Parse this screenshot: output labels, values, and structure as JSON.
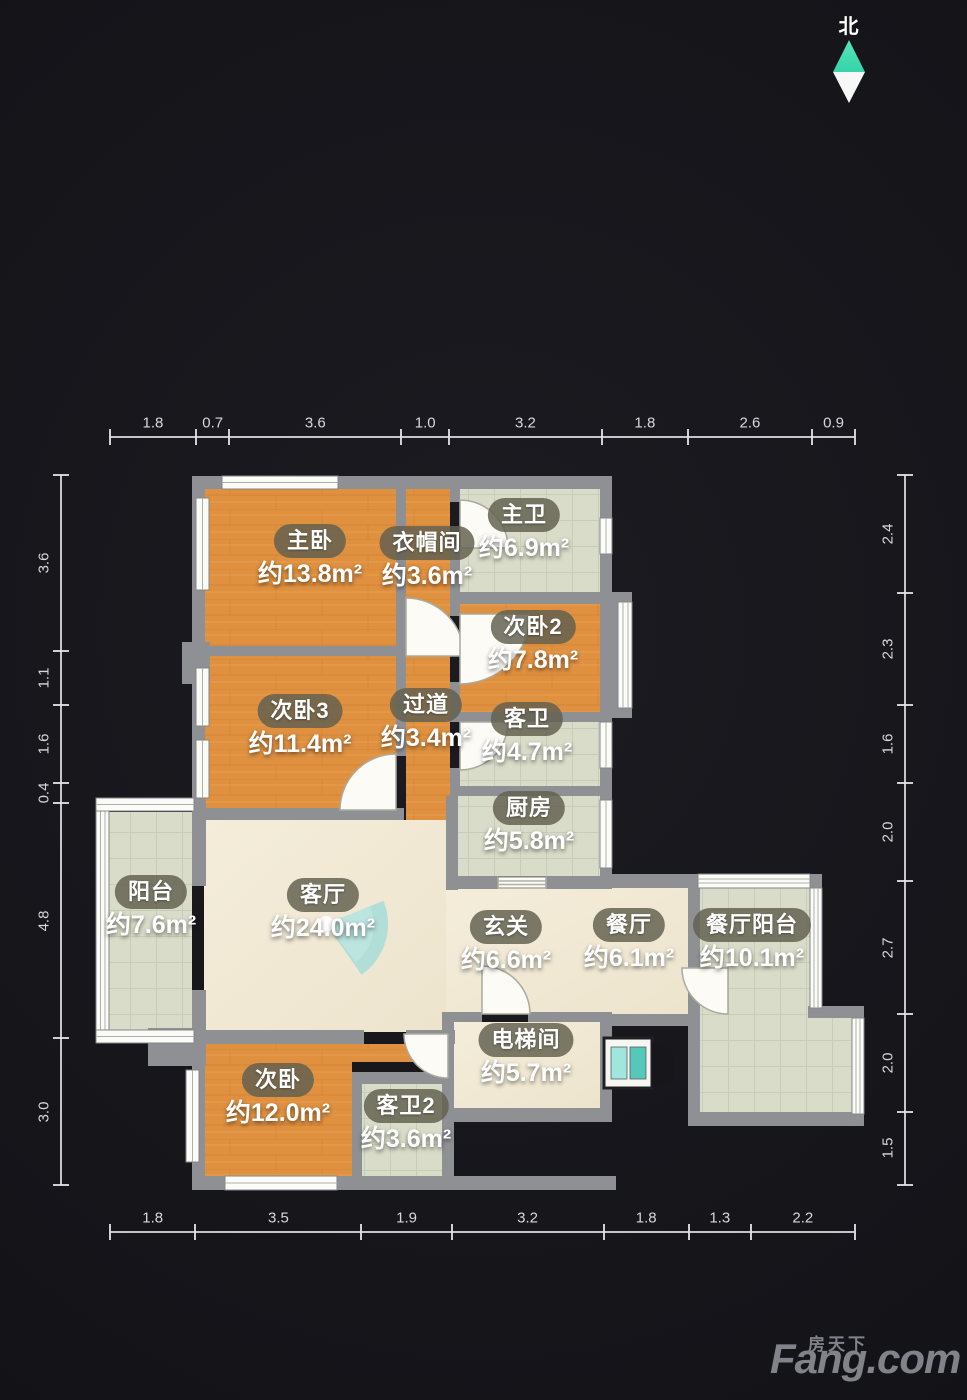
{
  "north": {
    "label": "北"
  },
  "watermark": {
    "site_cn": "房天下",
    "site_en": "Fang.com"
  },
  "dims": {
    "top": [
      "1.8",
      "0.7",
      "3.6",
      "1.0",
      "3.2",
      "1.8",
      "2.6",
      "0.9"
    ],
    "bottom": [
      "1.8",
      "3.5",
      "1.9",
      "3.2",
      "1.8",
      "1.3",
      "2.2"
    ],
    "left": [
      "3.6",
      "1.1",
      "1.6",
      "0.4",
      "4.8",
      "3.0"
    ],
    "right": [
      "2.4",
      "2.3",
      "1.6",
      "2.0",
      "2.7",
      "2.0",
      "1.5"
    ]
  },
  "rooms": [
    {
      "id": "master-bedroom",
      "name": "主卧",
      "area": "约13.8m²",
      "floor": "wood",
      "cx": 310,
      "cy": 540
    },
    {
      "id": "cloakroom",
      "name": "衣帽间",
      "area": "约3.6m²",
      "floor": "wood",
      "cx": 427,
      "cy": 542
    },
    {
      "id": "master-bath",
      "name": "主卫",
      "area": "约6.9m²",
      "floor": "tile",
      "cx": 524,
      "cy": 514
    },
    {
      "id": "bedroom2",
      "name": "次卧2",
      "area": "约7.8m²",
      "floor": "wood",
      "cx": 533,
      "cy": 626
    },
    {
      "id": "bedroom3",
      "name": "次卧3",
      "area": "约11.4m²",
      "floor": "wood",
      "cx": 300,
      "cy": 710
    },
    {
      "id": "hallway",
      "name": "过道",
      "area": "约3.4m²",
      "floor": "wood",
      "cx": 426,
      "cy": 704
    },
    {
      "id": "guest-bath",
      "name": "客卫",
      "area": "约4.7m²",
      "floor": "tile",
      "cx": 527,
      "cy": 718
    },
    {
      "id": "kitchen",
      "name": "厨房",
      "area": "约5.8m²",
      "floor": "tile",
      "cx": 529,
      "cy": 807
    },
    {
      "id": "balcony",
      "name": "阳台",
      "area": "约7.6m²",
      "floor": "tile",
      "cx": 151,
      "cy": 891
    },
    {
      "id": "living-room",
      "name": "客厅",
      "area": "约24.0m²",
      "floor": "cream",
      "cx": 323,
      "cy": 894
    },
    {
      "id": "entry",
      "name": "玄关",
      "area": "约6.6m²",
      "floor": "cream",
      "cx": 506,
      "cy": 926
    },
    {
      "id": "dining-room",
      "name": "餐厅",
      "area": "约6.1m²",
      "floor": "cream",
      "cx": 629,
      "cy": 924
    },
    {
      "id": "dining-balcony",
      "name": "餐厅阳台",
      "area": "约10.1m²",
      "floor": "tile",
      "cx": 752,
      "cy": 924
    },
    {
      "id": "elevator-hall",
      "name": "电梯间",
      "area": "约5.7m²",
      "floor": "cream",
      "cx": 526,
      "cy": 1039
    },
    {
      "id": "bedroom",
      "name": "次卧",
      "area": "约12.0m²",
      "floor": "wood",
      "cx": 278,
      "cy": 1079
    },
    {
      "id": "guest-bath2",
      "name": "客卫2",
      "area": "约3.6m²",
      "floor": "tile",
      "cx": 406,
      "cy": 1105
    }
  ],
  "colors": {
    "wood_floor": "#e09140",
    "tile_floor": "#d9dcc9",
    "cream_floor": "#f1e9d6",
    "wall": "#8e9094",
    "north_teal": "#35d3a8",
    "label_pill": "#63614f",
    "fan_teal": "#a6dcd8"
  }
}
